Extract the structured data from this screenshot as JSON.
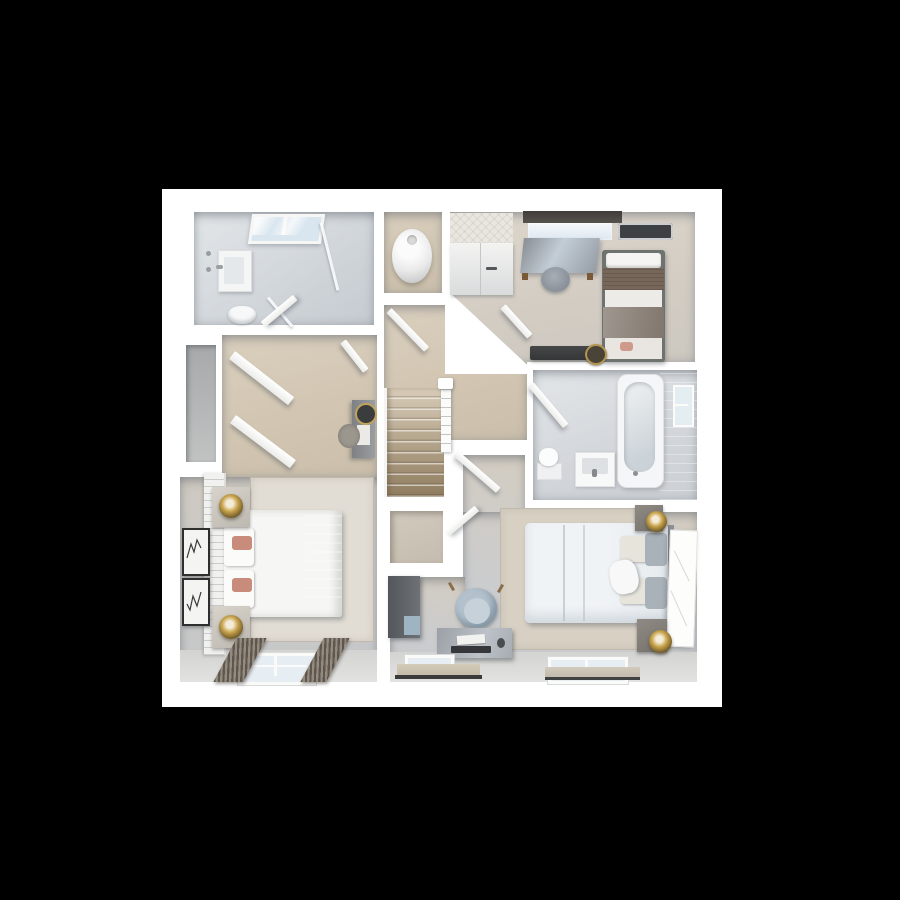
{
  "scene": {
    "title": "First floor 3D floor plan render, top-down view",
    "type": "3d-floorplan",
    "background": "#000000",
    "plan_background": "#ffffff"
  },
  "palette": {
    "page_background": "#000000",
    "wall_white": "#ffffff",
    "tile_grey": "#d2d6da",
    "carpet_beige": "#d1c5b1",
    "carpet_grey": "#c9c9c8",
    "stair_top": "#d8ccb8",
    "stair_bottom": "#8f7c5f",
    "accent_pink": "#c98d7f",
    "accent_blue": "#aebfcc",
    "lamp_gold": "#caa64e",
    "dark_furniture": "#4a4d50"
  },
  "rooms": [
    {
      "id": "ensuite-bathroom",
      "name": "En-suite Bathroom",
      "position": "top-left",
      "floor": "grey tile",
      "furniture": [
        "skylight window",
        "vanity basin",
        "shower fittings",
        "toilet",
        "glass shower screen"
      ]
    },
    {
      "id": "airing-cupboard",
      "name": "Airing Cupboard",
      "position": "top-middle",
      "floor": "beige carpet",
      "furniture": [
        "hot water cylinder"
      ]
    },
    {
      "id": "bedroom-3",
      "name": "Bedroom 3",
      "position": "top-right",
      "floor": "beige carpet",
      "furniture": [
        "quilted wardrobe",
        "desk",
        "stool",
        "single bed with brown blanket",
        "window with dark pelmet",
        "ceiling vent",
        "storage bench",
        "round basket"
      ]
    },
    {
      "id": "family-bathroom",
      "name": "Family Bathroom",
      "position": "middle-right",
      "floor": "grey tile",
      "furniture": [
        "bathtub",
        "toilet",
        "basin unit",
        "window",
        "door"
      ]
    },
    {
      "id": "landing",
      "name": "Landing",
      "position": "center",
      "floor": "beige carpet",
      "furniture": [
        "staircase",
        "banister",
        "doors to rooms"
      ]
    },
    {
      "id": "storage-cupboard",
      "name": "Storage Cupboard",
      "position": "center",
      "floor": "beige carpet",
      "furniture": [
        "cupboard door"
      ]
    },
    {
      "id": "dressing-area",
      "name": "Dressing Area",
      "position": "middle-left",
      "floor": "beige carpet",
      "furniture": [
        "open wardrobe doors",
        "tall dresser with round mirror",
        "round rug",
        "storage alcove"
      ]
    },
    {
      "id": "master-bedroom",
      "name": "Master Bedroom",
      "position": "bottom-left",
      "floor": "grey carpet",
      "furniture": [
        "double bed with pink throw",
        "slatted headboard",
        "glass bedside tables",
        "gold lamps",
        "two framed artworks",
        "area rug",
        "window with striped curtains"
      ]
    },
    {
      "id": "bedroom-2",
      "name": "Bedroom 2",
      "position": "bottom-right",
      "floor": "grey carpet",
      "furniture": [
        "double bed with blue-grey bedding",
        "bedside cabinets",
        "gold lamps",
        "leaning white mirror",
        "desk with laptop",
        "blue tub chair",
        "dark wardrobe panel",
        "area rug",
        "two windows"
      ]
    }
  ]
}
